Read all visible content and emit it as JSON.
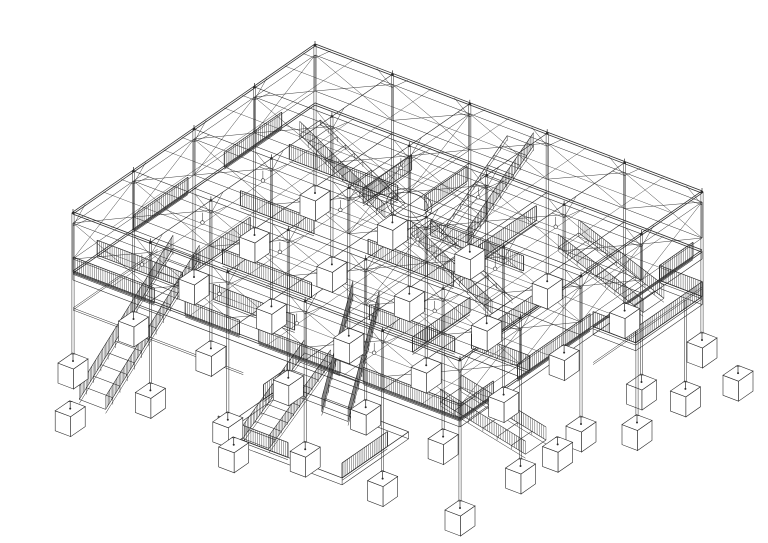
{
  "page": {
    "background": "#ffffff",
    "description": "Axonometric black-and-white line drawing of a two-level steel pavilion: open roof grid on slender posts, X-braced floor trusses, hatched guardrail partitions, multiple staircases, a right-side balcony, a ground-level deck, and stilt columns landing on cube footings."
  },
  "drawing": {
    "line_color": "#2a2a2a",
    "projection": {
      "origin": [
        315,
        45
      ],
      "axis_u": [
        -60.5,
        42
      ],
      "axis_v": [
        77.4,
        29.4
      ]
    },
    "levels": {
      "roof_z": 0,
      "floor_z": -59,
      "truss_top_z": -10,
      "truss_bottom_z": -46,
      "ground_z": -148,
      "rail_height": 15,
      "footing_height": 20
    },
    "grid": {
      "bays_u": 4,
      "bays_v": 5
    },
    "trusses": {
      "u_rows": [
        0,
        1,
        2,
        3,
        4
      ],
      "v_rows": [
        [
          0,
          0,
          4
        ],
        [
          5,
          0,
          4
        ],
        [
          2,
          0,
          2
        ],
        [
          3,
          1,
          3
        ]
      ]
    },
    "railings": [
      [
        4,
        0,
        4,
        1.05
      ],
      [
        4,
        1.45,
        4,
        2.15
      ],
      [
        4,
        2.4,
        4,
        3.45
      ],
      [
        4,
        3.75,
        4,
        5
      ],
      [
        3.45,
        5,
        4,
        5
      ],
      [
        1.85,
        5,
        3.05,
        5
      ],
      [
        0.15,
        5,
        0.7,
        5
      ],
      [
        0.55,
        0,
        1.5,
        0
      ],
      [
        2.1,
        0,
        3.0,
        0
      ],
      [
        1,
        0.45,
        1,
        1.85
      ],
      [
        2,
        0.6,
        2,
        1.55
      ],
      [
        2,
        2.25,
        2,
        3.35
      ],
      [
        1.35,
        2.55,
        1.35,
        3.75
      ],
      [
        3,
        1.15,
        3,
        2.3
      ],
      [
        3,
        3.05,
        3,
        4.15
      ],
      [
        0.5,
        3.25,
        1.45,
        3.25
      ],
      [
        2.35,
        1,
        3.3,
        1
      ],
      [
        2.3,
        3.8,
        3.25,
        3.8
      ],
      [
        0.45,
        1.6,
        1.25,
        1.6
      ],
      [
        1.6,
        4.3,
        2.6,
        4.3
      ],
      [
        2.85,
        4.25,
        2.85,
        5
      ],
      [
        0.3,
        2.2,
        1,
        2.2
      ],
      [
        3.6,
        0,
        3.6,
        1.1
      ],
      [
        3.6,
        1.5,
        3.6,
        2.55
      ]
    ],
    "balcony": {
      "u1": 0.7,
      "u2": 1.8,
      "v1": 5,
      "v2": 5.55,
      "stilts": [
        [
          0.85,
          5.45
        ],
        [
          1.65,
          5.45
        ]
      ],
      "rails": [
        [
          0.7,
          5.55,
          1.8,
          5.55
        ],
        [
          0.7,
          5,
          0.7,
          5.55
        ],
        [
          1.8,
          5,
          1.8,
          5.55
        ]
      ]
    },
    "ground_deck": {
      "u1": 3.25,
      "u2": 4.35,
      "v1": 2.15,
      "v2": 3.75,
      "z": -140,
      "rails": [
        [
          4.35,
          2.15,
          4.35,
          3.05
        ],
        [
          3.6,
          3.75,
          4.35,
          3.75
        ],
        [
          3.25,
          2.15,
          3.6,
          2.15
        ]
      ]
    },
    "oval": {
      "u": 1.0,
      "v": 2.0,
      "rx": 23,
      "ry": 15.5,
      "tilt": 14
    },
    "stairs": [
      {
        "from": [
          3.05,
          0.55,
          -59
        ],
        "to": [
          4.6,
          0.55,
          -145
        ],
        "steps": 13,
        "rails": 2
      },
      {
        "from": [
          2.7,
          2.6,
          -59
        ],
        "to": [
          3.6,
          2.9,
          -130
        ],
        "steps": 9,
        "rails": 2
      },
      {
        "from": [
          2.45,
          3.8,
          -128
        ],
        "to": [
          2.45,
          4.9,
          -148
        ],
        "steps": 6,
        "rails": 2
      },
      {
        "from": [
          0.95,
          4.15,
          -26
        ],
        "to": [
          0.95,
          5.25,
          -59
        ],
        "steps": 9,
        "rails": 2
      },
      {
        "from": [
          1.0,
          0.85,
          -8
        ],
        "to": [
          1.0,
          1.95,
          -59
        ],
        "steps": 10,
        "rails": 1
      },
      {
        "from": [
          0.15,
          2.6,
          -8
        ],
        "to": [
          1.25,
          2.6,
          -59
        ],
        "steps": 10,
        "rails": 1
      },
      {
        "from": [
          1.85,
          2.95,
          -10
        ],
        "to": [
          1.85,
          4.0,
          -59
        ],
        "steps": 10,
        "rails": 1
      },
      {
        "from": [
          2.8,
          2.05,
          -130
        ],
        "to": [
          4.2,
          2.35,
          -148
        ],
        "steps": 10,
        "rails": 2
      }
    ],
    "under_beams": [
      [
        4,
        0,
        4,
        2.2,
        -95
      ],
      [
        0,
        5,
        1.8,
        5,
        -95
      ],
      [
        2.6,
        0,
        4,
        0,
        -95
      ]
    ],
    "lights": [
      [
        0.5,
        1.5
      ],
      [
        0.5,
        2.5
      ],
      [
        0.5,
        3.5
      ],
      [
        1.5,
        0.5
      ],
      [
        1.5,
        1.5
      ],
      [
        1.5,
        2.5
      ],
      [
        1.5,
        3.5
      ],
      [
        2.5,
        0.5
      ],
      [
        2.5,
        1.5
      ],
      [
        2.5,
        3.5
      ],
      [
        3.5,
        0.5
      ],
      [
        3.5,
        1.5
      ],
      [
        3.5,
        2.5
      ],
      [
        3.5,
        3.5
      ]
    ],
    "extra_footings": [
      [
        4.75,
        0.55
      ],
      [
        4.35,
        2.35
      ],
      [
        2.45,
        5.05
      ],
      [
        0.3,
        5.7
      ]
    ]
  }
}
